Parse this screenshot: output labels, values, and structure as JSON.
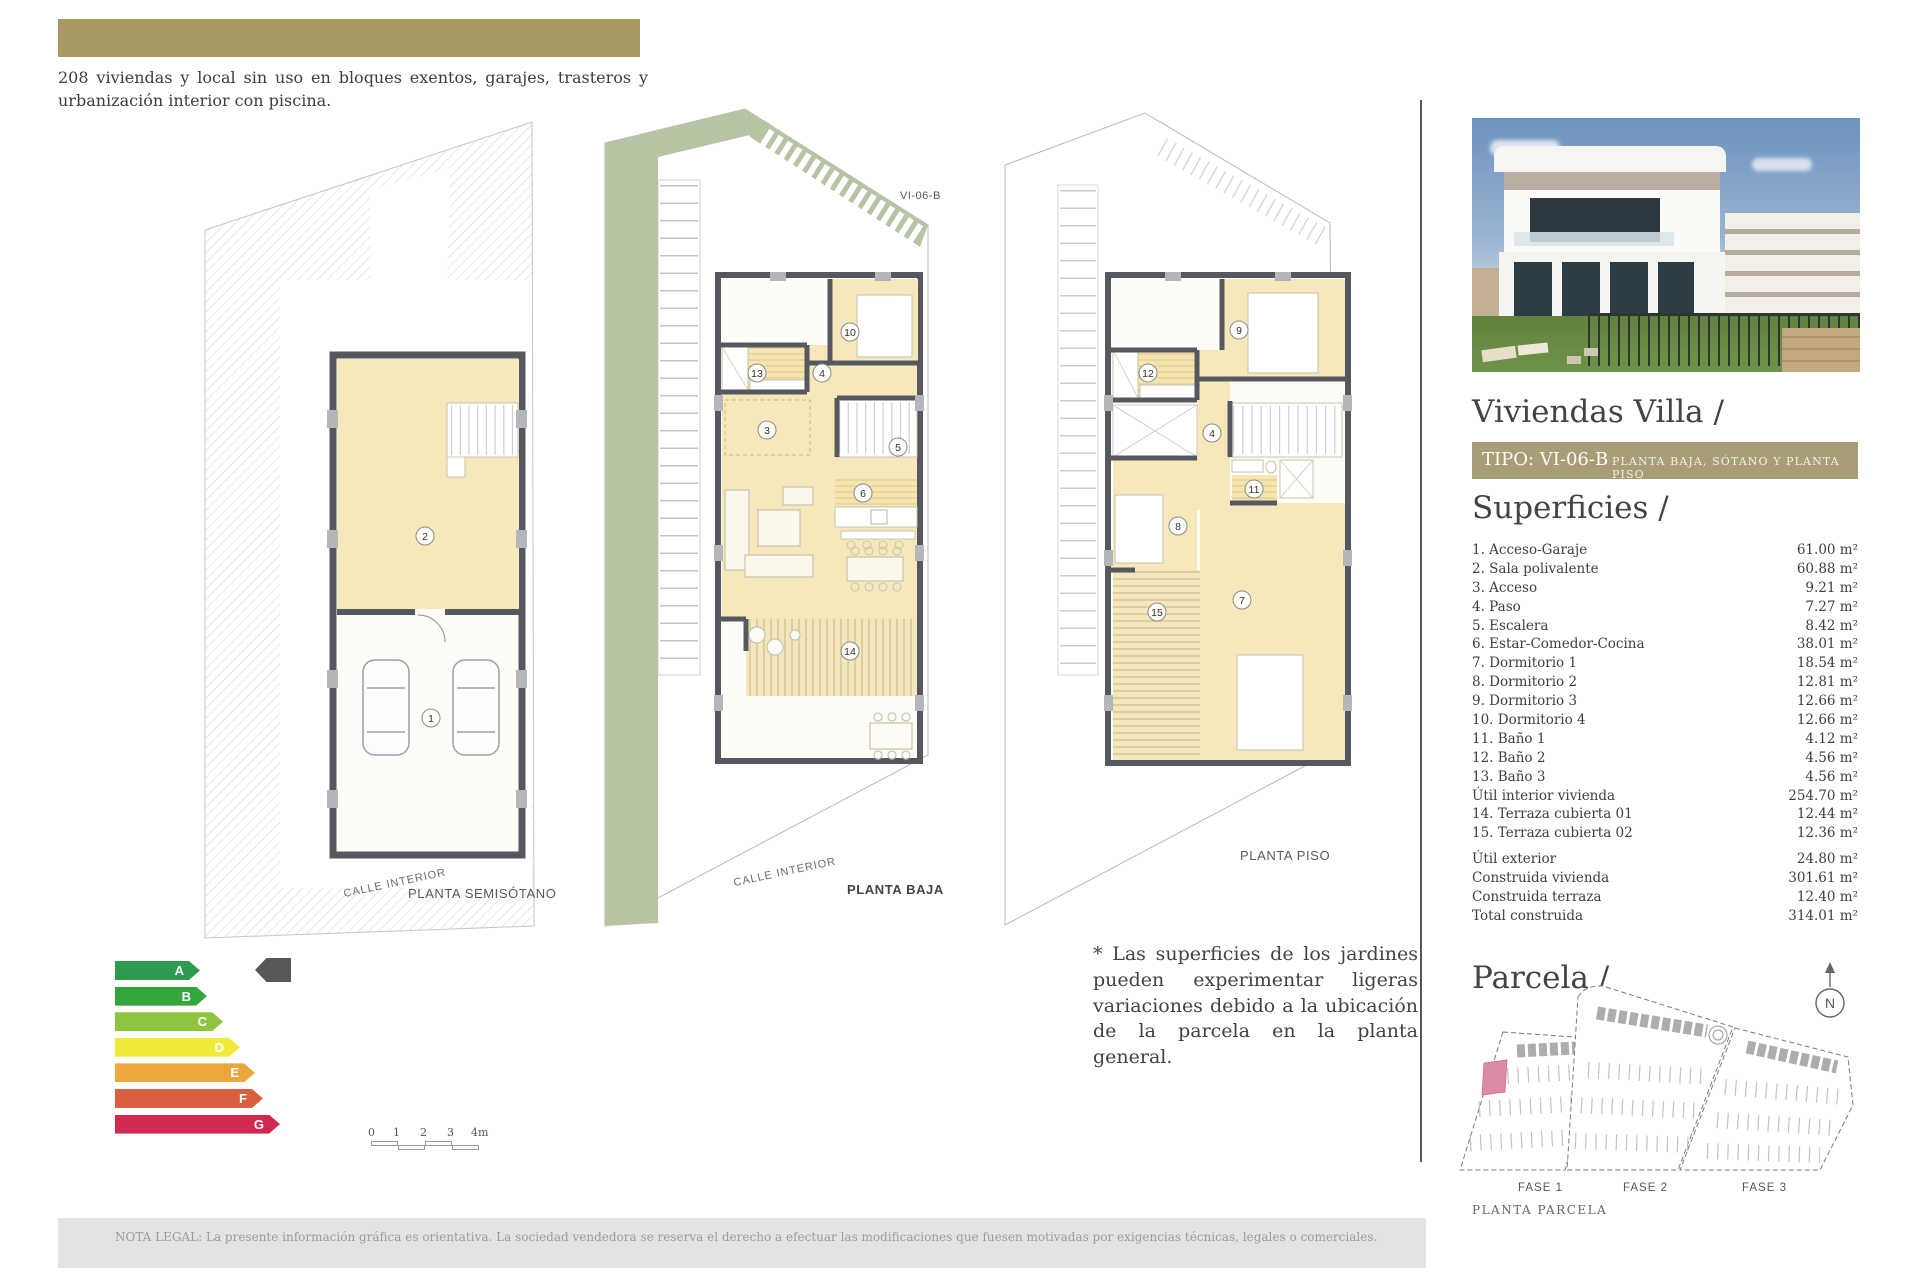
{
  "header": {
    "intro_text": "208 viviendas y local sin uso en bloques exentos, garajes, trasteros y urbanización interior con piscina."
  },
  "plans": {
    "semisotano": {
      "label": "PLANTA SEMISÓTANO",
      "street_label": "CALLE INTERIOR",
      "rooms": [
        "2",
        "1"
      ]
    },
    "baja": {
      "label": "PLANTA BAJA",
      "street_label": "CALLE INTERIOR",
      "code": "VI-06-B",
      "rooms": [
        "13",
        "4",
        "3",
        "10",
        "5",
        "6",
        "14"
      ]
    },
    "piso": {
      "label": "PLANTA PISO",
      "rooms": [
        "9",
        "12",
        "4",
        "11",
        "8",
        "7",
        "15"
      ]
    }
  },
  "scale_bar": {
    "ticks": [
      "0",
      "1",
      "2",
      "3",
      "4m"
    ]
  },
  "energy_label": {
    "pointer_color": "#57585a",
    "grades": [
      {
        "letter": "A",
        "color": "#2e9b4e"
      },
      {
        "letter": "B",
        "color": "#35a63c"
      },
      {
        "letter": "C",
        "color": "#8fc43e"
      },
      {
        "letter": "D",
        "color": "#f2ea3a"
      },
      {
        "letter": "E",
        "color": "#eca63e"
      },
      {
        "letter": "F",
        "color": "#da5f41"
      },
      {
        "letter": "G",
        "color": "#d02a50"
      }
    ]
  },
  "note_text": "* Las superficies de los jardines pueden experimentar ligeras variaciones debido a la ubicación de la parcela en la planta general.",
  "panel": {
    "title": "Viviendas Villa /",
    "tipo_label": "TIPO: VI-06-B",
    "tipo_sublabel": "PLANTA BAJA, SÓTANO Y PLANTA PISO",
    "accent_color": "#a79d77",
    "superficies": {
      "title": "Superficies /",
      "rows": [
        {
          "label": "1. Acceso-Garaje",
          "value": "61.00 m²"
        },
        {
          "label": "2. Sala polivalente",
          "value": "60.88 m²"
        },
        {
          "label": "3. Acceso",
          "value": "9.21 m²"
        },
        {
          "label": "4. Paso",
          "value": "7.27 m²"
        },
        {
          "label": "5. Escalera",
          "value": "8.42 m²"
        },
        {
          "label": "6. Estar-Comedor-Cocina",
          "value": "38.01 m²"
        },
        {
          "label": "7. Dormitorio 1",
          "value": "18.54 m²"
        },
        {
          "label": "8. Dormitorio 2",
          "value": "12.81 m²"
        },
        {
          "label": "9. Dormitorio 3",
          "value": "12.66 m²"
        },
        {
          "label": "10. Dormitorio 4",
          "value": "12.66 m²"
        },
        {
          "label": "11. Baño 1",
          "value": "4.12 m²"
        },
        {
          "label": "12. Baño 2",
          "value": "4.56 m²"
        },
        {
          "label": "13. Baño 3",
          "value": "4.56 m²"
        },
        {
          "label": "Útil interior vivienda",
          "value": "254.70 m²"
        },
        {
          "label": "14. Terraza cubierta 01",
          "value": "12.44 m²"
        },
        {
          "label": "15. Terraza cubierta 02",
          "value": "12.36 m²"
        }
      ],
      "totals": [
        {
          "label": "Útil exterior",
          "value": "24.80 m²"
        },
        {
          "label": "Construida vivienda",
          "value": "301.61 m²"
        },
        {
          "label": "Construida terraza",
          "value": "12.40 m²"
        },
        {
          "label": "Total construida",
          "value": "314.01 m²"
        }
      ]
    },
    "parcela": {
      "title": "Parcela /",
      "north_label": "N",
      "fases": [
        "FASE 1",
        "FASE 2",
        "FASE 3"
      ],
      "caption": "PLANTA PARCELA",
      "highlight_color": "#dd8aa4"
    }
  },
  "footer": {
    "legal_text": "NOTA LEGAL: La presente información gráfica es orientativa. La sociedad vendedora se reserva el derecho a efectuar las modificaciones que fuesen motivadas por exigencias técnicas, legales o comerciales."
  }
}
